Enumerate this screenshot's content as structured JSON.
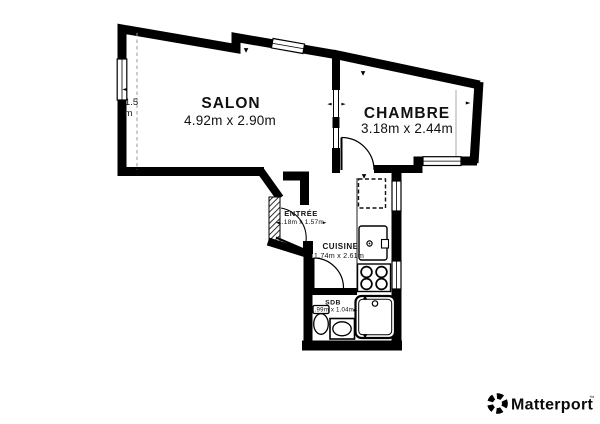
{
  "plan": {
    "rooms": [
      {
        "name": "SALON",
        "dims": "4.92m x 2.90m"
      },
      {
        "name": "CHAMBRE",
        "dims": "3.18m x 2.44m"
      },
      {
        "name": "ENTRÉE",
        "dims": "1.18m x 1.57m"
      },
      {
        "name": "CUISINE",
        "dims": "1.74m x 2.61m"
      },
      {
        "name": "SDB",
        "dims": "1.99m x 1.04m"
      }
    ],
    "low_ceiling": {
      "value": "1.5",
      "unit": "m"
    },
    "icons": {
      "arrow_left": "◄",
      "arrow_right": "►",
      "arrow_up": "▲",
      "arrow_down": "▼"
    },
    "colors": {
      "wall": "#000000",
      "background": "#ffffff",
      "text": "#111111"
    }
  },
  "branding": {
    "logo_text": "Matterport",
    "trademark": "™"
  }
}
